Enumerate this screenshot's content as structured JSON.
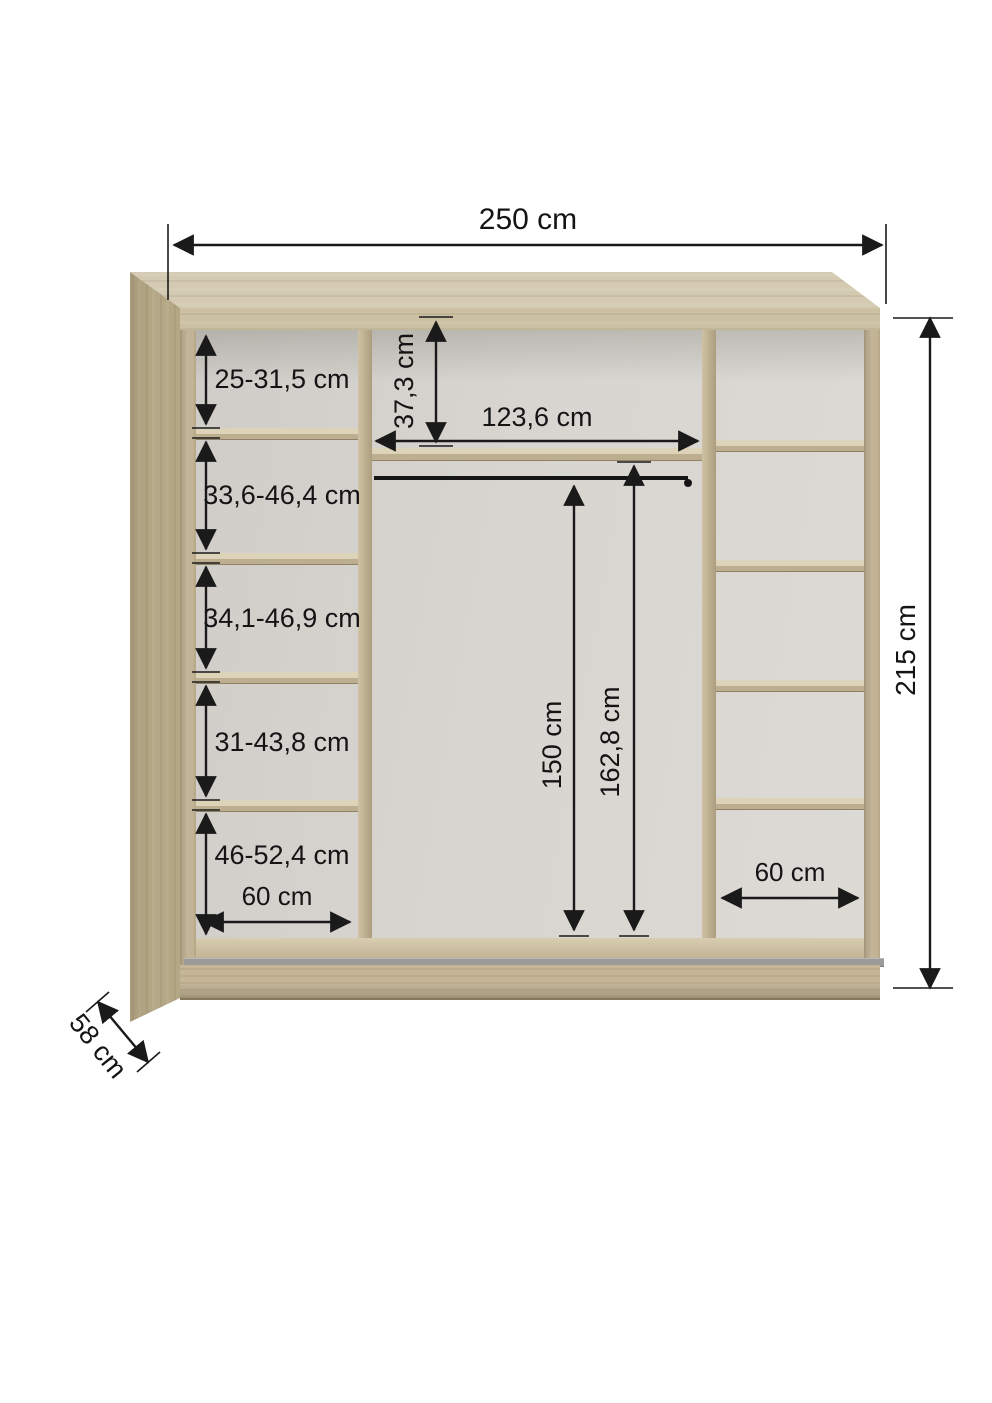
{
  "diagram": {
    "overall": {
      "width": "250 cm",
      "height": "215 cm",
      "depth": "58 cm"
    },
    "left_column": {
      "compartments": [
        {
          "label": "25-31,5 cm"
        },
        {
          "label": "33,6-46,4 cm"
        },
        {
          "label": "34,1-46,9 cm"
        },
        {
          "label": "31-43,8 cm"
        },
        {
          "label": "46-52,4 cm"
        }
      ],
      "width_label": "60 cm"
    },
    "middle_column": {
      "width_label": "123,6 cm",
      "top_shelf_offset_label": "37,3 cm",
      "rod_height_label": "150 cm",
      "hanging_height_label": "162,8 cm"
    },
    "right_column": {
      "width_label": "60 cm"
    },
    "colors": {
      "wood": "#c9bc9e",
      "wood_dark": "#b4a785",
      "back_wall": "#d6d3ce",
      "track": "#9c9b99",
      "dimension_line": "#1a1a1a"
    }
  }
}
